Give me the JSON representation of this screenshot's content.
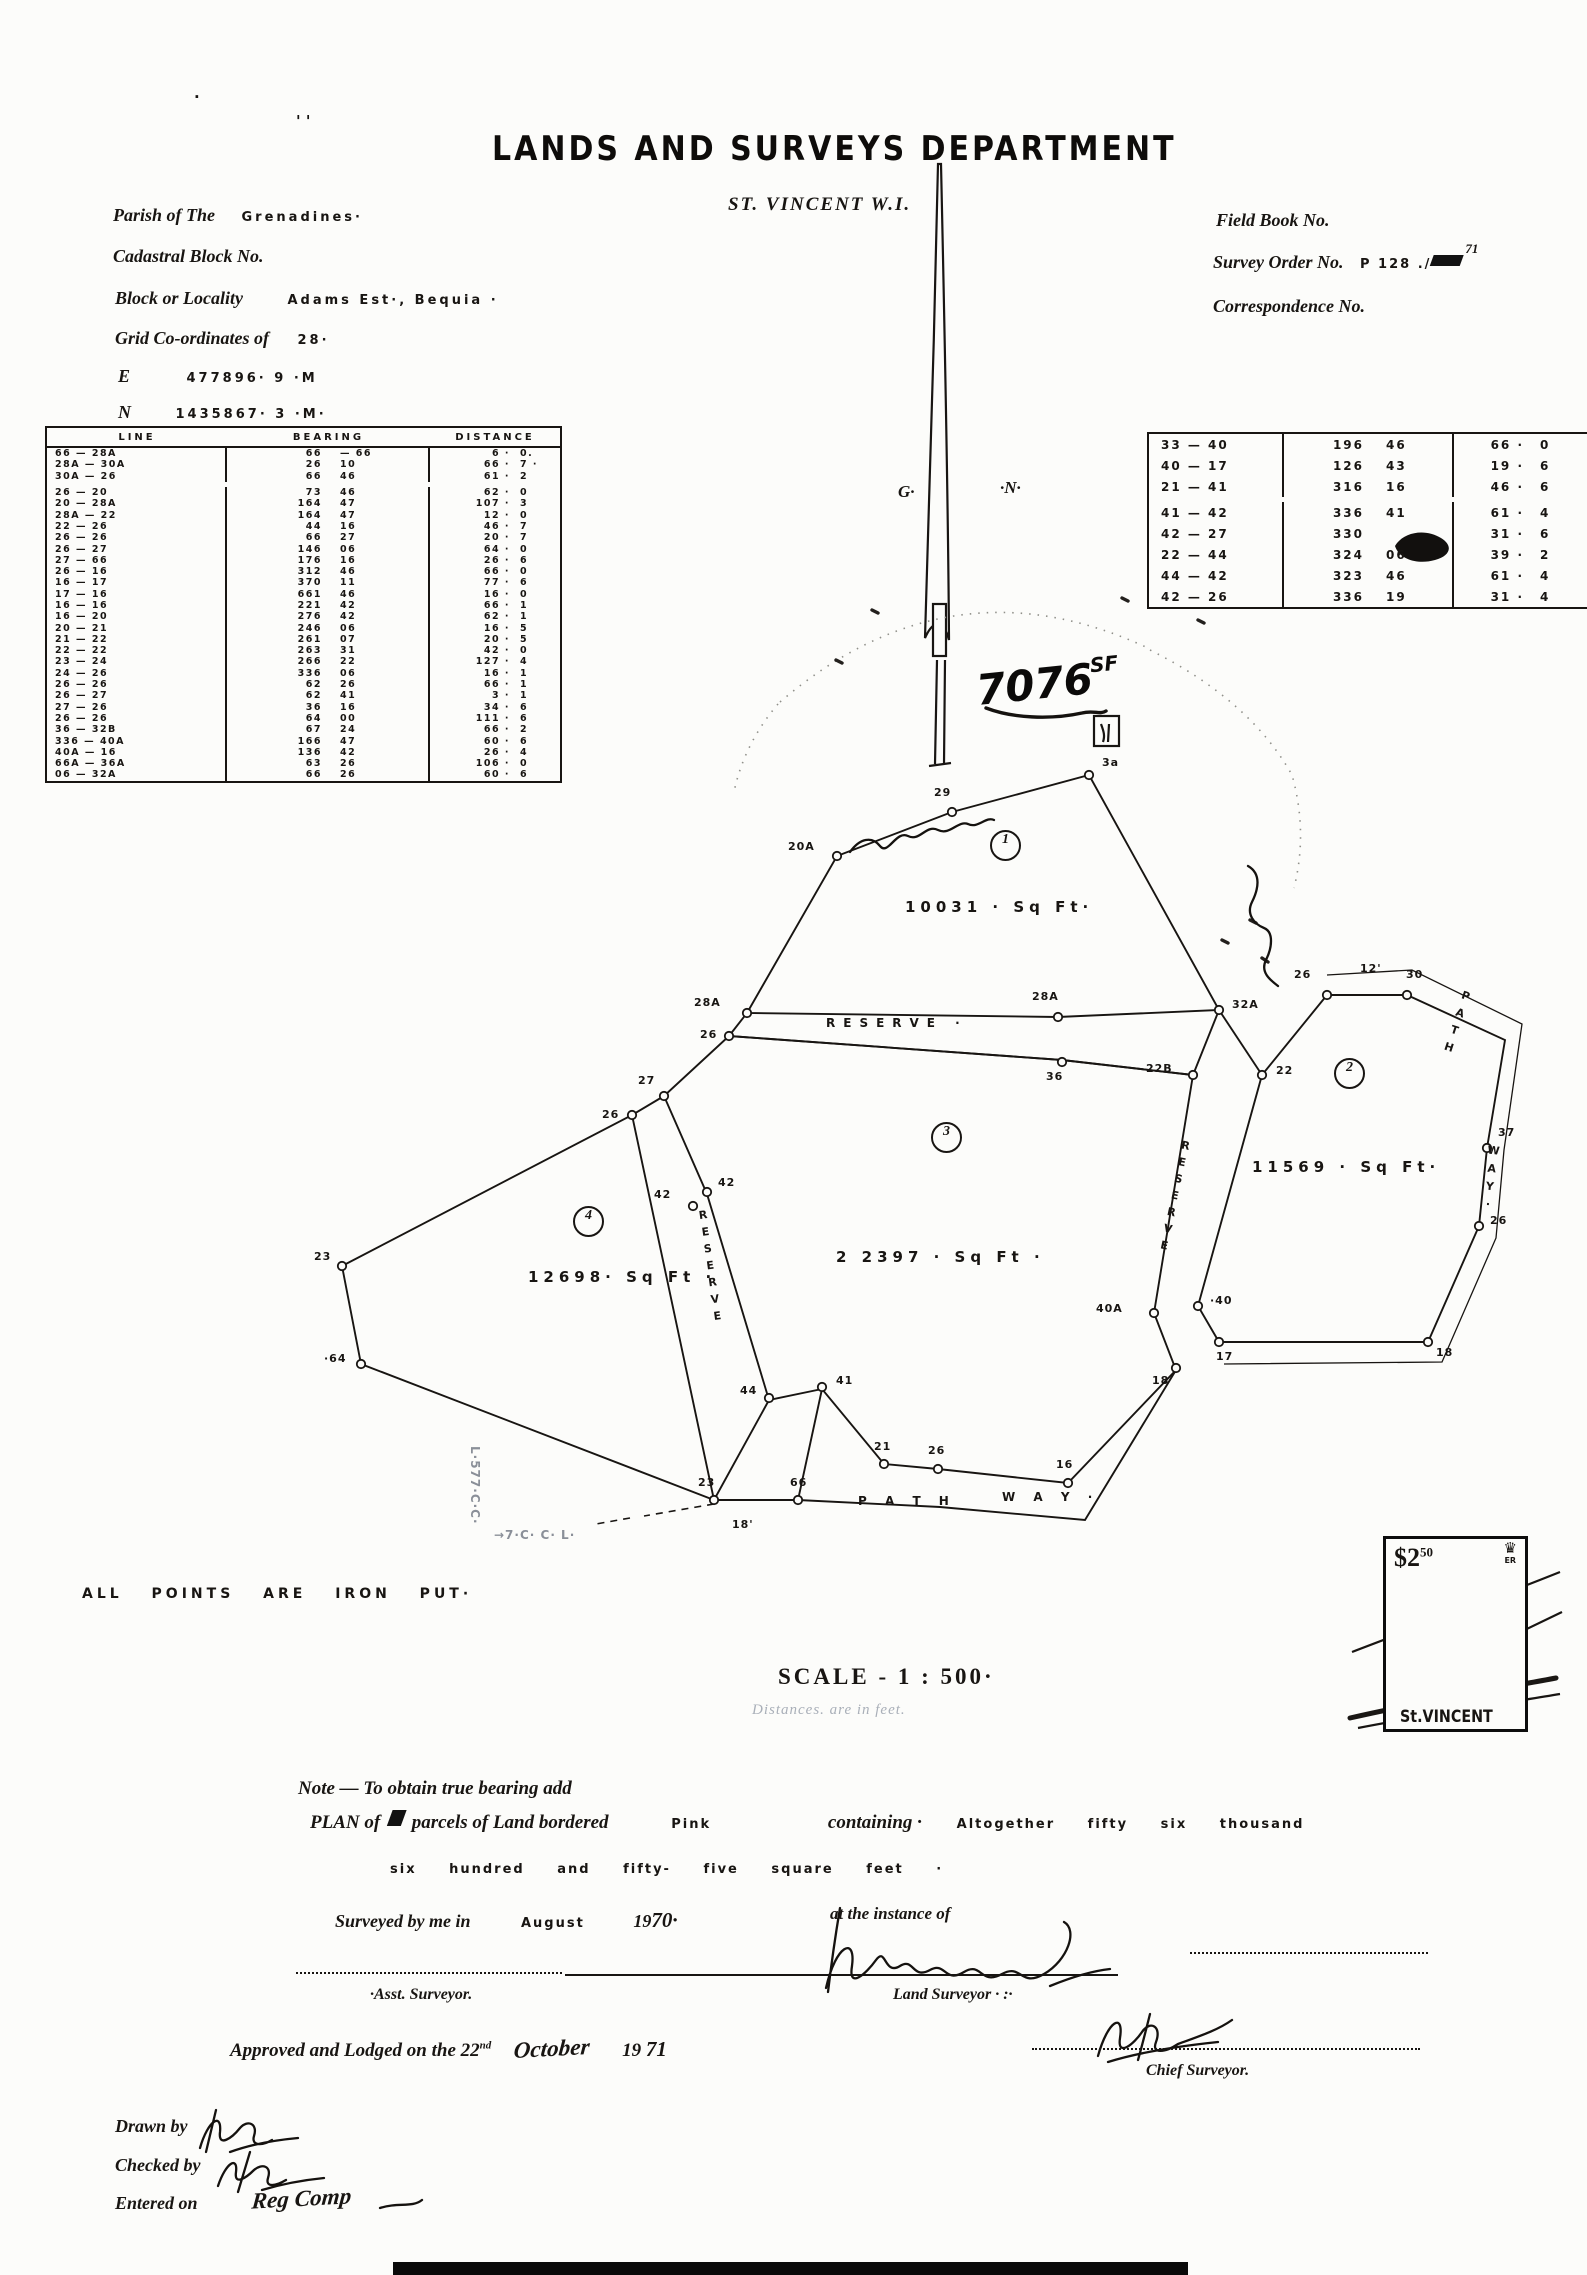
{
  "document": {
    "title": "LANDS AND SURVEYS DEPARTMENT",
    "subtitle": "ST. VINCENT W.I."
  },
  "header_left": {
    "parish_label": "Parish of The",
    "parish_value": "Grenadines·",
    "cadastral_label": "Cadastral Block No.",
    "block_label": "Block or Locality",
    "block_value": "Adams  Est·,  Bequia ·",
    "grid_label": "Grid Co-ordinates of",
    "grid_value": "28·",
    "e_label": "E",
    "e_value": "477896· 9    ·M",
    "n_label": "N",
    "n_value": "1435867· 3    ·M·"
  },
  "header_right": {
    "field_book": "Field Book No.",
    "survey_order_label": "Survey Order No.",
    "survey_order_value": "P 128 ./",
    "survey_order_sup": "71",
    "correspondence": "Correspondence No."
  },
  "main_table": {
    "headers": [
      "LINE",
      "BEARING",
      "DISTANCE"
    ],
    "rows": [
      [
        "66 — 28A",
        "66",
        "—  66",
        "6 ·",
        "0."
      ],
      [
        "28A — 30A",
        "26",
        "10",
        "66 ·",
        "7 ·"
      ],
      [
        "30A — 26",
        "66",
        "46",
        "61 ·",
        "2"
      ],
      [
        "26 — 20",
        "73",
        "46",
        "62 ·",
        "0"
      ],
      [
        "20 — 28A",
        "164",
        "47",
        "107 ·",
        "3"
      ],
      [
        "28A — 22",
        "164",
        "47",
        "12 ·",
        "0"
      ],
      [
        "22 — 26",
        "44",
        "16",
        "46 ·",
        "7"
      ],
      [
        "26 — 26",
        "66",
        "27",
        "20 ·",
        "7"
      ],
      [
        "26 — 27",
        "146",
        "06",
        "64 ·",
        "0"
      ],
      [
        "27 — 66",
        "176",
        "16",
        "26 ·",
        "6"
      ],
      [
        "26 — 16",
        "312",
        "46",
        "66 ·",
        "0"
      ],
      [
        "16 — 17",
        "370",
        "11",
        "77 ·",
        "6"
      ],
      [
        "17 — 16",
        "661",
        "46",
        "16 ·",
        "0"
      ],
      [
        "16 — 16",
        "221",
        "42",
        "66 ·",
        "1"
      ],
      [
        "16 — 20",
        "276",
        "42",
        "62 ·",
        "1"
      ],
      [
        "20 — 21",
        "246",
        "06",
        "16 ·",
        "5"
      ],
      [
        "21 — 22",
        "261",
        "07",
        "20 ·",
        "5"
      ],
      [
        "22 — 22",
        "263",
        "31",
        "42 ·",
        "0"
      ],
      [
        "23 — 24",
        "266",
        "22",
        "127 ·",
        "4"
      ],
      [
        "24 — 26",
        "336",
        "06",
        "16 ·",
        "1"
      ],
      [
        "26 — 26",
        "62",
        "26",
        "66 ·",
        "1"
      ],
      [
        "26 — 27",
        "62",
        "41",
        "3 ·",
        "1"
      ],
      [
        "27 — 26",
        "36",
        "16",
        "34 ·",
        "6"
      ],
      [
        "26 — 26",
        "64",
        "00",
        "111 ·",
        "6"
      ],
      [
        "36 — 32B",
        "67",
        "24",
        "66 ·",
        "2"
      ],
      [
        "336 — 40A",
        "166",
        "47",
        "60 ·",
        "6"
      ],
      [
        "40A — 16",
        "136",
        "42",
        "26 ·",
        "4"
      ],
      [
        "66A — 36A",
        "63",
        "26",
        "106 ·",
        "0"
      ],
      [
        "06 — 32A",
        "66",
        "26",
        "60 ·",
        "6"
      ]
    ]
  },
  "side_table": {
    "rows": [
      [
        "33 — 40",
        "196",
        "46",
        "66 ·",
        "0"
      ],
      [
        "40 — 17",
        "126",
        "43",
        "19 ·",
        "6"
      ],
      [
        "21 — 41",
        "316",
        "16",
        "46 ·",
        "6"
      ],
      [
        "41 — 42",
        "336",
        "41",
        "61 ·",
        "4"
      ],
      [
        "42 — 27",
        "330",
        "",
        "31 ·",
        "6"
      ],
      [
        "22 — 44",
        "324",
        "06",
        "39 ·",
        "2"
      ],
      [
        "44 — 42",
        "323",
        "46",
        "61 ·",
        "4"
      ],
      [
        "42 — 26",
        "336",
        "19",
        "31 ·",
        "4"
      ]
    ]
  },
  "plan": {
    "points": [
      "837,856",
      "952,812",
      "1089,775",
      "1219,1010",
      "1193,1075",
      "1058,1017",
      "1062,1062",
      "747,1013",
      "729,1036",
      "664,1096",
      "632,1115",
      "707,1192",
      "693,1206",
      "769,1398",
      "822,1387",
      "342,1266",
      "361,1364",
      "714,1500",
      "798,1500",
      "884,1464",
      "938,1469",
      "1068,1483",
      "1176,1368",
      "1198,1306",
      "1154,1313",
      "1219,1342",
      "1428,1342",
      "1479,1226",
      "1487,1148",
      "1407,995",
      "1327,995",
      "1262,1075"
    ],
    "labels": [
      {
        "t": "20A",
        "x": 788,
        "y": 840,
        "c": "pt"
      },
      {
        "t": "29",
        "x": 934,
        "y": 786,
        "c": "pt"
      },
      {
        "t": "3a",
        "x": 1102,
        "y": 756,
        "c": "pt"
      },
      {
        "t": "32A",
        "x": 1232,
        "y": 998,
        "c": "pt"
      },
      {
        "t": "22B",
        "x": 1146,
        "y": 1062,
        "c": "pt"
      },
      {
        "t": "28A",
        "x": 1032,
        "y": 990,
        "c": "pt"
      },
      {
        "t": "36",
        "x": 1046,
        "y": 1070,
        "c": "pt"
      },
      {
        "t": "28A",
        "x": 694,
        "y": 996,
        "c": "pt"
      },
      {
        "t": "26",
        "x": 700,
        "y": 1028,
        "c": "pt"
      },
      {
        "t": "27",
        "x": 638,
        "y": 1074,
        "c": "pt"
      },
      {
        "t": "26",
        "x": 602,
        "y": 1108,
        "c": "pt"
      },
      {
        "t": "42",
        "x": 654,
        "y": 1188,
        "c": "pt"
      },
      {
        "t": "42",
        "x": 718,
        "y": 1176,
        "c": "pt"
      },
      {
        "t": "44",
        "x": 740,
        "y": 1384,
        "c": "pt"
      },
      {
        "t": "41",
        "x": 836,
        "y": 1374,
        "c": "pt"
      },
      {
        "t": "23",
        "x": 314,
        "y": 1250,
        "c": "pt"
      },
      {
        "t": "·64",
        "x": 324,
        "y": 1352,
        "c": "pt"
      },
      {
        "t": "23",
        "x": 698,
        "y": 1476,
        "c": "pt"
      },
      {
        "t": "66",
        "x": 790,
        "y": 1476,
        "c": "pt"
      },
      {
        "t": "21",
        "x": 874,
        "y": 1440,
        "c": "pt"
      },
      {
        "t": "26",
        "x": 928,
        "y": 1444,
        "c": "pt"
      },
      {
        "t": "16",
        "x": 1056,
        "y": 1458,
        "c": "pt"
      },
      {
        "t": "18",
        "x": 1152,
        "y": 1374,
        "c": "pt"
      },
      {
        "t": "·40",
        "x": 1210,
        "y": 1294,
        "c": "pt"
      },
      {
        "t": "40A",
        "x": 1096,
        "y": 1302,
        "c": "pt"
      },
      {
        "t": "17",
        "x": 1216,
        "y": 1350,
        "c": "pt"
      },
      {
        "t": "18",
        "x": 1436,
        "y": 1346,
        "c": "pt"
      },
      {
        "t": "26",
        "x": 1490,
        "y": 1214,
        "c": "pt"
      },
      {
        "t": "37",
        "x": 1498,
        "y": 1126,
        "c": "pt"
      },
      {
        "t": "30",
        "x": 1406,
        "y": 968,
        "c": "pt"
      },
      {
        "t": "26",
        "x": 1294,
        "y": 968,
        "c": "pt"
      },
      {
        "t": "22",
        "x": 1276,
        "y": 1064,
        "c": "pt"
      },
      {
        "t": "12'",
        "x": 1360,
        "y": 962,
        "c": "pt"
      },
      {
        "t": "18'",
        "x": 732,
        "y": 1518,
        "c": "pt"
      },
      {
        "t": "G·",
        "x": 898,
        "y": 482,
        "c": "gn"
      },
      {
        "t": "·N·",
        "x": 1000,
        "y": 478,
        "c": "gn"
      },
      {
        "t": "' '",
        "x": 296,
        "y": 112,
        "c": "mark"
      },
      {
        "t": "·",
        "x": 194,
        "y": 88,
        "c": "mark"
      },
      {
        "t": "1",
        "x": 990,
        "y": 830,
        "c": "circ"
      },
      {
        "t": "2",
        "x": 1334,
        "y": 1058,
        "c": "circ"
      },
      {
        "t": "3",
        "x": 931,
        "y": 1122,
        "c": "circ"
      },
      {
        "t": "4",
        "x": 573,
        "y": 1206,
        "c": "circ"
      },
      {
        "t": "10031 · Sq Ft·",
        "x": 905,
        "y": 898,
        "c": "area"
      },
      {
        "t": "11569 ·  Sq Ft·",
        "x": 1252,
        "y": 1158,
        "c": "area"
      },
      {
        "t": "2 2397 · Sq Ft ·",
        "x": 836,
        "y": 1248,
        "c": "area"
      },
      {
        "t": "12698· Sq Ft ·",
        "x": 528,
        "y": 1268,
        "c": "area"
      },
      {
        "t": "RESERVE ·",
        "x": 826,
        "y": 1016,
        "c": "resv-h"
      },
      {
        "t": "RESERVE",
        "x": 1168,
        "y": 1138,
        "c": "resv-v",
        "r": 12
      },
      {
        "t": "RESERVE",
        "x": 704,
        "y": 1208,
        "c": "resv-v",
        "r": -8
      },
      {
        "t": "P A T H",
        "x": 858,
        "y": 1494,
        "c": "pw"
      },
      {
        "t": "W A Y ·",
        "x": 1002,
        "y": 1490,
        "c": "pw"
      },
      {
        "t": "PATH",
        "x": 1450,
        "y": 988,
        "c": "pw-v",
        "r": 18
      },
      {
        "t": "WAY·",
        "x": 1484,
        "y": 1144,
        "c": "pw-v",
        "r": 6
      },
      {
        "t": "L·577·C·C·",
        "x": 468,
        "y": 1446,
        "c": "faint-v"
      },
      {
        "t": "→7·C· C· L·",
        "x": 494,
        "y": 1528,
        "c": "faint"
      },
      {
        "t": "7076",
        "x": 976,
        "y": 660,
        "c": "hand-big",
        "r": -6
      },
      {
        "t": "SF",
        "x": 1090,
        "y": 652,
        "c": "hand-sm",
        "r": -6
      }
    ],
    "shapes": [
      {
        "k": "pa",
        "d": "M938,164 C935,320 929,500 925,638 C933,620 943,618 949,640 C948,480 944,300 941,164 Z",
        "c": "o2",
        "n": "north-arrow"
      },
      {
        "k": "rect",
        "x": 933,
        "y": 604,
        "w": 13,
        "h": 52,
        "c": "o2f",
        "n": "north-arrow"
      },
      {
        "k": "pa",
        "d": "M937,660 L935,764 M945,660 L944,764 M929,766 L951,763",
        "c": "o2",
        "n": "north-arrow"
      },
      {
        "k": "poly",
        "p": "837,856 952,812 1089,775 1219,1010 1058,1017 747,1013",
        "c": "o",
        "n": "parcel-1-boundary"
      },
      {
        "k": "pl",
        "p": "729,1036 1062,1060 1193,1075",
        "c": "o",
        "n": "reserve-line"
      },
      {
        "k": "pl",
        "p": "747,1013 729,1036",
        "c": "o",
        "n": "reserve-line"
      },
      {
        "k": "poly",
        "p": "729,1036 1062,1060 1193,1075 1154,1313 1176,1370 1068,1483 938,1469 884,1464 822,1389 769,1400 707,1194 664,1096",
        "c": "o",
        "n": "parcel-3-boundary"
      },
      {
        "k": "poly",
        "p": "342,1266 632,1115 714,1500 361,1364",
        "c": "o",
        "n": "parcel-4-boundary"
      },
      {
        "k": "pl",
        "p": "632,1115 664,1096",
        "c": "o",
        "n": "reserve-line"
      },
      {
        "k": "poly",
        "p": "1262,1075 1327,995 1407,995 1505,1040 1487,1148 1479,1226 1428,1342 1219,1342 1198,1306",
        "c": "o",
        "n": "parcel-2-boundary"
      },
      {
        "k": "pl",
        "p": "1219,1010 1193,1075",
        "c": "o",
        "n": "reserve-line"
      },
      {
        "k": "pl",
        "p": "1219,1010 1262,1075",
        "c": "o",
        "n": "reserve-line"
      },
      {
        "k": "pl",
        "p": "769,1400 714,1500",
        "c": "o",
        "n": "reserve-line"
      },
      {
        "k": "pl",
        "p": "822,1389 798,1500",
        "c": "o",
        "n": "reserve-line"
      },
      {
        "k": "pl",
        "p": "714,1500 798,1500 940,1507 1085,1520 1176,1370",
        "c": "o",
        "n": "pathway-line"
      },
      {
        "k": "pl",
        "p": "1327,975 1412,970 1522,1024 1504,1150 1496,1238 1442,1362 1224,1364",
        "c": "t",
        "n": "pathway-line"
      },
      {
        "k": "pa",
        "d": "M714,1504 L644,1516 M630,1518 L596,1524",
        "c": "d",
        "n": "dashed-boundary"
      },
      {
        "k": "pa",
        "d": "M780,702 Q950,556 1148,648",
        "c": "n",
        "n": "scan-noise"
      },
      {
        "k": "pa",
        "d": "M1150,650 Q1250,700 1292,775 Q1308,832 1294,888",
        "c": "n",
        "n": "scan-noise"
      },
      {
        "k": "pa",
        "d": "M778,704 Q744,744 734,792",
        "c": "n",
        "n": "scan-noise"
      },
      {
        "k": "pa",
        "d": "M1222,940 l6,3 M1250,920 l6,3 M1262,958 l6,4 M872,610 l6,3 M1122,598 l6,3 M1198,620 l6,3 M836,660 l6,3",
        "c": "k",
        "n": "scan-noise"
      },
      {
        "k": "pa",
        "d": "M850,852 c10,-14 22,-16 30,-6 c8,10 16,-16 28,-10 c12,6 18,-12 30,-6 c12,6 20,-10 30,-6 c10,5 18,-8 26,-4",
        "c": "s",
        "n": "handwritten-scribble"
      },
      {
        "k": "pa",
        "d": "M1248,866 c14,8 10,24 4,36 c-6,12 2,22 12,26 c10,4 8,20 2,32 c-6,12 4,20 12,26",
        "c": "s",
        "n": "handwritten-scribble"
      },
      {
        "k": "pa",
        "d": "M986,708 C1012,718 1050,720 1082,713 C1094,710 1100,715 1106,711",
        "c": "s3",
        "n": "handwritten-underline"
      },
      {
        "k": "rect",
        "x": 1094,
        "y": 716,
        "w": 25,
        "h": 30,
        "c": "o2f",
        "n": "handwritten-box"
      },
      {
        "k": "pa",
        "d": "M1101,724 C1104,732 1105,736 1103,742 M1109,724 L1108,742",
        "c": "o2",
        "n": "handwritten-mark"
      },
      {
        "k": "pa",
        "d": "M840,1908 C833,1950 830,1975 828,1992 M826,1988 C836,1944 856,1936 852,1966 C848,1990 866,1974 876,1960 C886,1946 884,1976 900,1966 C914,1957 912,1980 930,1970 C946,1961 944,1984 964,1972 C982,1961 980,1986 1002,1974 C1022,1963 1020,1988 1044,1974 C1068,1960 1078,1930 1064,1922 M1050,1986 C1072,1977 1092,1971 1110,1969",
        "c": "s",
        "n": "land-surveyor-signature"
      },
      {
        "k": "pa",
        "d": "M1098,2056 C1108,2020 1124,2012 1120,2038 C1117,2058 1134,2044 1142,2032 C1150,2020 1162,2026 1156,2042 C1151,2055 1166,2052 1178,2044 C1200,2036 1218,2030 1232,2020 M1108,2062 C1140,2052 1180,2046 1218,2042 M1150,2014 C1146,2030 1142,2046 1138,2060",
        "c": "s",
        "n": "chief-surveyor-signature"
      },
      {
        "k": "pa",
        "d": "M200,2148 C208,2120 222,2112 220,2132 C218,2148 232,2138 240,2128 C248,2119 258,2124 254,2136 C251,2146 262,2146 272,2140 M216,2110 L206,2152 M230,2152 C252,2144 276,2140 298,2138",
        "c": "s",
        "n": "drawn-by-signature"
      },
      {
        "k": "pa",
        "d": "M218,2186 C226,2162 238,2156 236,2172 C234,2186 246,2178 254,2170 C262,2163 272,2166 268,2178 C265,2188 276,2186 286,2180 M250,2152 L238,2192 M262,2190 C282,2184 304,2180 324,2178",
        "c": "s",
        "n": "checked-by-signature"
      },
      {
        "k": "pa",
        "d": "M380,2208 C398,2202 412,2208 422,2200",
        "c": "s",
        "n": "entered-on-flourish"
      },
      {
        "k": "pa",
        "d": "M1395,546 C1403,532 1425,528 1441,538 C1454,546 1450,556 1435,560 C1417,565 1399,559 1395,546 Z",
        "c": "b",
        "n": "ink-smudge"
      },
      {
        "k": "pa",
        "d": "M1405,1648 C1398,1634 1406,1626 1420,1620 C1414,1606 1424,1598 1438,1594 C1436,1580 1448,1570 1464,1568 C1470,1554 1486,1548 1500,1554 C1512,1560 1516,1572 1512,1584 C1522,1590 1524,1600 1518,1610 C1528,1618 1528,1628 1518,1634 C1526,1642 1522,1652 1508,1656 C1488,1662 1462,1662 1440,1658 C1424,1664 1410,1660 1405,1648 Z",
        "c": "b",
        "n": "stamp-bird-illustration"
      },
      {
        "k": "pa",
        "d": "M1396,1678 C1430,1670 1480,1666 1516,1668 M1466,1658 L1470,1672 M1482,1656 L1488,1670",
        "c": "s3",
        "n": "stamp-bird-illustration"
      },
      {
        "k": "pa",
        "d": "M1350,1718 C1420,1702 1492,1690 1556,1678",
        "c": "c5",
        "n": "postmark-line"
      },
      {
        "k": "pa",
        "d": "M1358,1728 C1430,1714 1500,1704 1560,1694",
        "c": "o2",
        "n": "postmark-line"
      },
      {
        "k": "pa",
        "d": "M1392,1694 L1562,1612",
        "c": "o2",
        "n": "postmark-line"
      },
      {
        "k": "pa",
        "d": "M1352,1652 C1420,1626 1500,1596 1560,1572",
        "c": "o2",
        "n": "postmark-line"
      },
      {
        "k": "rect",
        "x": 393,
        "y": 2262,
        "w": 795,
        "h": 13,
        "c": "bf",
        "n": "bottom-scan-bar"
      }
    ]
  },
  "notes": {
    "all_points": "ALL   POINTS   ARE   IRON   PUT·",
    "scale": "SCALE -    1 : 500·",
    "distances_faint": "Distances. are in feet.",
    "note_bearing": "Note — To obtain true bearing add",
    "plan_of": "PLAN of",
    "plan_fill_blot": "4",
    "plan_parcels": "parcels of Land bordered",
    "plan_pink": "Pink",
    "plan_containing": "containing  ·",
    "plan_amount1": "Altogether   fifty   six   thousand",
    "plan_amount2": "six    hundred    and    fifty-  five   square   feet ·",
    "surveyed_by": "Surveyed by me in",
    "surveyed_month": "August",
    "surveyed_year_pre": "19",
    "surveyed_year_hand": "70·",
    "instance": "at the instance of",
    "asst_surveyor": "·Asst. Surveyor.",
    "land_surveyor": "Land Surveyor · :·",
    "approved_pre": "Approved and Lodged on the 22",
    "approved_sup": "nd",
    "approved_month": "October",
    "approved_year_pre": "19",
    "approved_year_hand": "71",
    "chief_surveyor": "Chief Surveyor.",
    "drawn_by": "Drawn by",
    "checked_by": "Checked by",
    "entered_on": "Entered on",
    "entered_value": "Reg Comp"
  },
  "stamp": {
    "price": "$2",
    "price_sup": "50",
    "crown": "♛",
    "crown_sub": "ER",
    "country": "St.VINCENT"
  }
}
